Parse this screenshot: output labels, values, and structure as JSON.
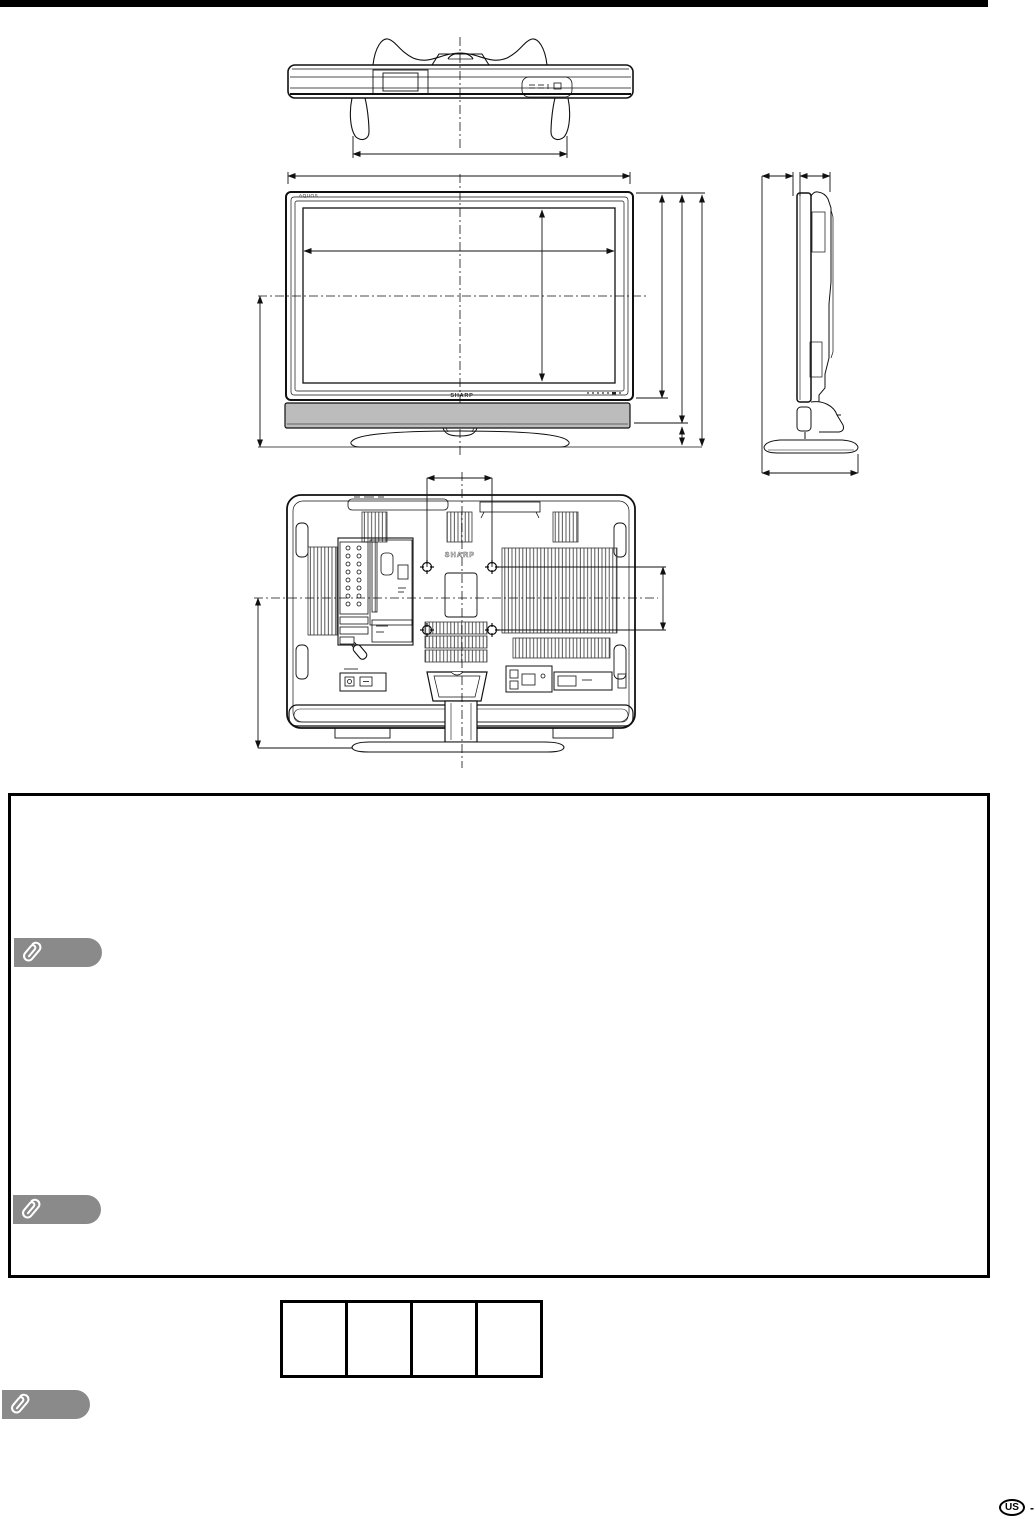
{
  "page": {
    "region_badge": "US",
    "badge_suffix": "-"
  },
  "front_view": {
    "brand_top": "AQUOS",
    "brand_bottom": "SHARP"
  },
  "rear_view": {
    "brand": "SHARP"
  },
  "note_tags": [
    {
      "icon": "paperclip"
    },
    {
      "icon": "paperclip"
    },
    {
      "icon": "paperclip"
    }
  ],
  "size_table": {
    "cells": [
      "",
      "",
      "",
      ""
    ]
  },
  "colors": {
    "top_bar": "#000000",
    "note_tag_gray": "#8a8a8a",
    "speaker_bar_gray": "#bcbcbc",
    "line_black": "#111111"
  }
}
